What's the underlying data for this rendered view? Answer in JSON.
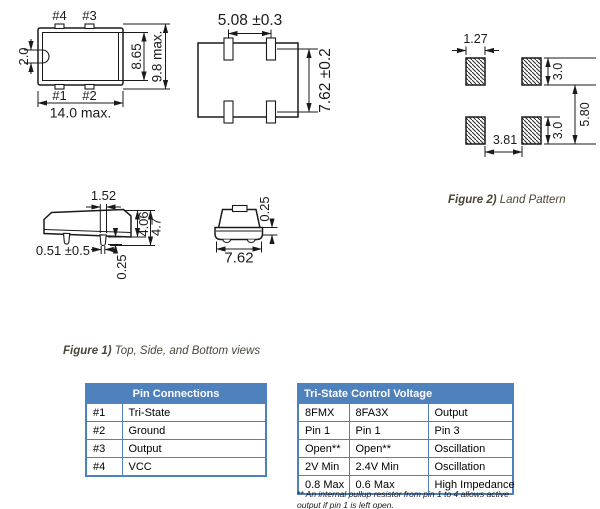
{
  "captions": {
    "figure1_label": "Figure 1)",
    "figure1_text": " Top, Side, and Bottom views",
    "figure2_label": "Figure 2)",
    "figure2_text": " Land Pattern"
  },
  "drawings": {
    "top_view": {
      "pin4": "#4",
      "pin3": "#3",
      "pin1": "#1",
      "pin2": "#2",
      "dim_notch": "2.0",
      "dim_inner_height": "8.65",
      "dim_outer_height": "9.8 max.",
      "dim_width": "14.0 max."
    },
    "bottom_view": {
      "dim_pad_pitch": "5.08 ±0.3",
      "dim_row_pitch": "7.62 ±0.2"
    },
    "land_pattern": {
      "dim_pad_width": "1.27",
      "dim_pad_height_top": "3.0",
      "dim_pad_height_bottom": "3.0",
      "dim_vertical_pitch": "5.80",
      "dim_horizontal_gap": "3.81"
    },
    "side_view": {
      "dim_lead_width_body": "1.52",
      "dim_body_height": "4.06",
      "dim_total_height": "4.7",
      "dim_lead_width_tip": "0.51 ±0.5",
      "dim_standoff": "0.25"
    },
    "end_view": {
      "dim_lip": "0.25",
      "dim_width": "7.62"
    }
  },
  "tables": {
    "pin": {
      "title": "Pin Connections",
      "rows": [
        [
          "#1",
          "Tri-State"
        ],
        [
          "#2",
          "Ground"
        ],
        [
          "#3",
          "Output"
        ],
        [
          "#4",
          "VCC"
        ]
      ]
    },
    "tristate": {
      "title": "Tri-State Control Voltage",
      "rows": [
        [
          "8FMX",
          "8FA3X",
          "Output"
        ],
        [
          "Pin 1",
          "Pin 1",
          "Pin 3"
        ],
        [
          "Open**",
          "Open**",
          "Oscillation"
        ],
        [
          "2V Min",
          "2.4V Min",
          "Oscillation"
        ],
        [
          "0.8 Max",
          "0.6 Max",
          "High Impedance"
        ]
      ],
      "footnote": "** An internal pullup resistor from pin 1 to 4 allows active output if pin 1 is left open."
    }
  },
  "colors": {
    "table_header_bg": "#4f81bd",
    "table_border": "#4f81bd",
    "table_header_text": "#ffffff",
    "caption_text": "#4c4637",
    "line_color": "#1a1a1a"
  }
}
